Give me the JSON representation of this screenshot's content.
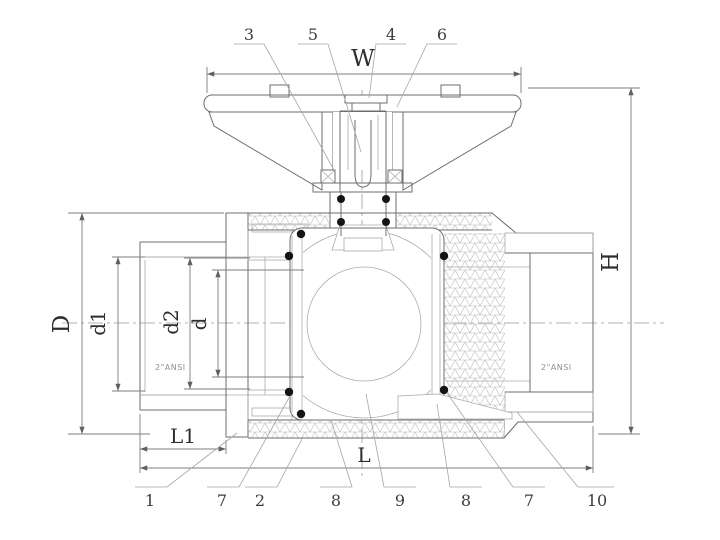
{
  "dims": {
    "w": "W",
    "h": "H",
    "D": "D",
    "d1": "d1",
    "d2": "d2",
    "d": "d",
    "l1": "L1",
    "l": "L"
  },
  "callouts_top": [
    "3",
    "5",
    "4",
    "6"
  ],
  "callouts_bottom": [
    "1",
    "7",
    "2",
    "8",
    "9",
    "8",
    "7",
    "10"
  ],
  "specs": {
    "left": "2\"ANSI",
    "right": "2\"ANSI"
  },
  "colors": {
    "background": "#ffffff",
    "line": "#6e6e6e",
    "hatch": "#9a9a9a",
    "text": "#2e2e2e",
    "oring": "#141414"
  }
}
